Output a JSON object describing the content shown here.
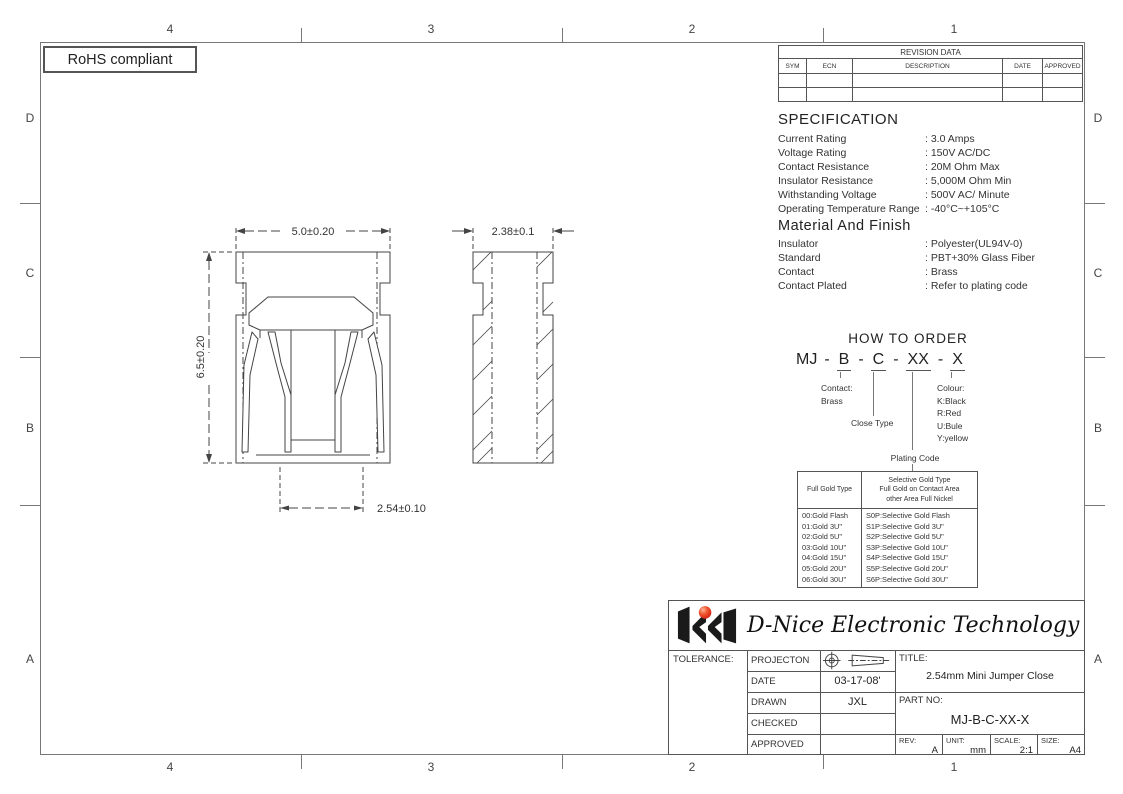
{
  "sheet": {
    "rohs_label": "RoHS compliant",
    "zone_cols": [
      "4",
      "3",
      "2",
      "1"
    ],
    "zone_rows": [
      "D",
      "C",
      "B",
      "A"
    ]
  },
  "revision_table": {
    "title": "REVISION DATA",
    "columns": [
      "SYM",
      "ECN",
      "DESCRIPTION",
      "DATE",
      "APPROVED"
    ]
  },
  "specification": {
    "title": "SPECIFICATION",
    "items": [
      {
        "label": "Current Rating",
        "value": ": 3.0 Amps"
      },
      {
        "label": "Voltage Rating",
        "value": ": 150V AC/DC"
      },
      {
        "label": "Contact Resistance",
        "value": ": 20M Ohm Max"
      },
      {
        "label": "Insulator Resistance",
        "value": ": 5,000M Ohm Min"
      },
      {
        "label": "Withstanding Voltage",
        "value": ": 500V AC/ Minute"
      },
      {
        "label": "Operating Temperature Range",
        "value": ": -40°C~+105°C"
      }
    ]
  },
  "material_finish": {
    "title": "Material And Finish",
    "items": [
      {
        "label": "Insulator",
        "value": ": Polyester(UL94V-0)"
      },
      {
        "label": "Standard",
        "value": ": PBT+30% Glass Fiber"
      },
      {
        "label": "Contact",
        "value": ": Brass"
      },
      {
        "label": "Contact Plated",
        "value": ": Refer to plating code"
      }
    ]
  },
  "how_to_order": {
    "title": "HOW TO ORDER",
    "prefix": "MJ",
    "separator": "-",
    "segments": [
      "B",
      "C",
      "XX",
      "X"
    ],
    "contact_label": "Contact:",
    "contact_value": "Brass",
    "close_label": "Close Type",
    "plating_label": "Plating Code",
    "colour_lines": [
      "Colour:",
      "K:Black",
      "R:Red",
      "U:Bule",
      "Y:yellow"
    ]
  },
  "plating_table": {
    "full_gold_header": "Full Gold Type",
    "selective_header": [
      "Selective Gold Type",
      "Full Gold on Contact Area",
      "other Area Full Nickel"
    ],
    "full_gold_rows": [
      "00:Gold Flash",
      "01:Gold 3U\"",
      "02:Gold 5U\"",
      "03:Gold 10U\"",
      "04:Gold 15U\"",
      "05:Gold 20U\"",
      "06:Gold 30U\""
    ],
    "selective_rows": [
      "S0P:Selective Gold Flash",
      "S1P:Selective Gold 3U\"",
      "S2P:Selective Gold 5U\"",
      "S3P:Selective Gold 10U\"",
      "S4P:Selective Gold 15U\"",
      "S5P:Selective Gold 20U\"",
      "S6P:Selective Gold 30U\""
    ]
  },
  "drawing": {
    "dim_width": "5.0±0.20",
    "dim_height": "6.5±0.20",
    "dim_side_width": "2.38±0.1",
    "dim_pitch": "2.54±0.10"
  },
  "title_block": {
    "company": "D-Nice Electronic Technology",
    "tolerance_label": "TOLERANCE:",
    "projection_label": "PROJECTON",
    "date_label": "DATE",
    "date_value": "03-17-08'",
    "drawn_label": "DRAWN",
    "drawn_value": "JXL",
    "checked_label": "CHECKED",
    "approved_label": "APPROVED",
    "title_label": "TITLE:",
    "title_value": "2.54mm Mini Jumper Close",
    "part_label": "PART  NO:",
    "part_value": "MJ-B-C-XX-X",
    "rev_label": "REV:",
    "rev_value": "A",
    "unit_label": "UNIT:",
    "unit_value": "mm",
    "scale_label": "SCALE:",
    "scale_value": "2:1",
    "size_label": "SIZE:",
    "size_value": "A4"
  }
}
